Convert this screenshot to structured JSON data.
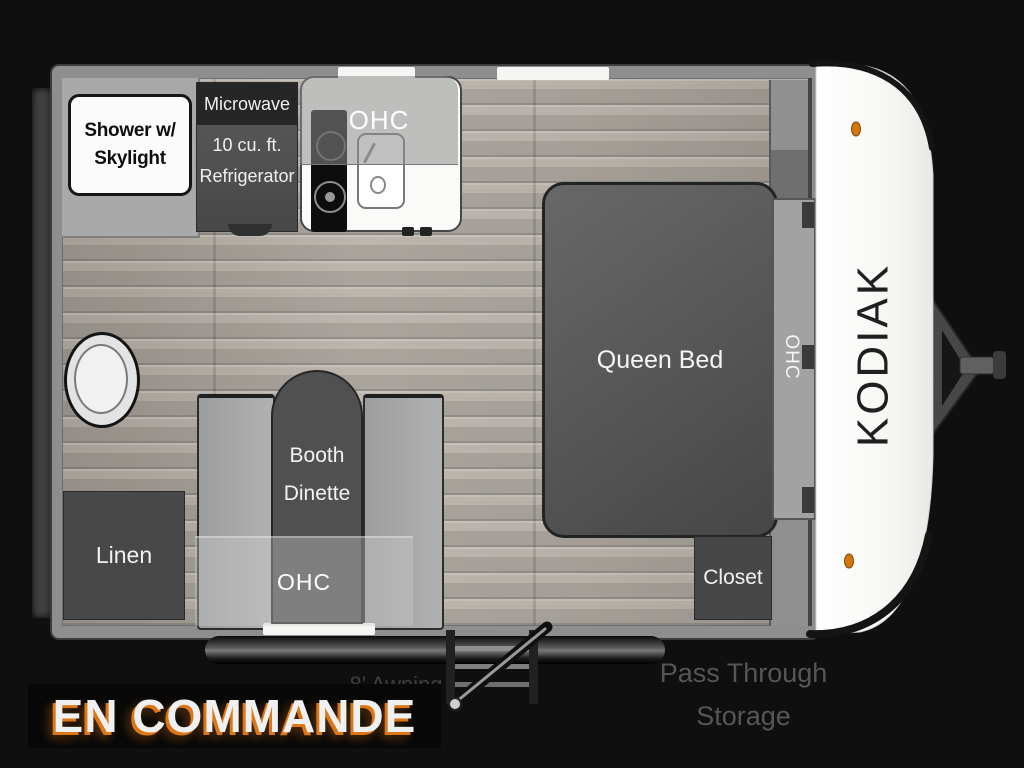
{
  "banner": {
    "text": "EN COMMANDE"
  },
  "exterior": {
    "brand": "KODIAK",
    "awning": "8' Awning",
    "pass_through_line1": "Pass Through",
    "pass_through_line2": "Storage"
  },
  "rooms": {
    "shower_line1": "Shower w/",
    "shower_line2": "Skylight",
    "microwave": "Microwave",
    "fridge_line1": "10 cu. ft.",
    "fridge_line2": "Refrigerator",
    "kitchen_ohc": "OHC",
    "queen_bed": "Queen Bed",
    "bed_ohc": "OHC",
    "dinette_line1": "Booth",
    "dinette_line2": "Dinette",
    "dinette_ohc": "OHC",
    "linen": "Linen",
    "closet": "Closet"
  },
  "colors": {
    "accent_orange": "#dd7715",
    "marker_light": "#d4760e",
    "wall_gray": "#8e8e8e",
    "furniture_dark": "#4a4a4a",
    "front_cap_white": "#f7f7f5",
    "background": "#0f0f0f"
  }
}
